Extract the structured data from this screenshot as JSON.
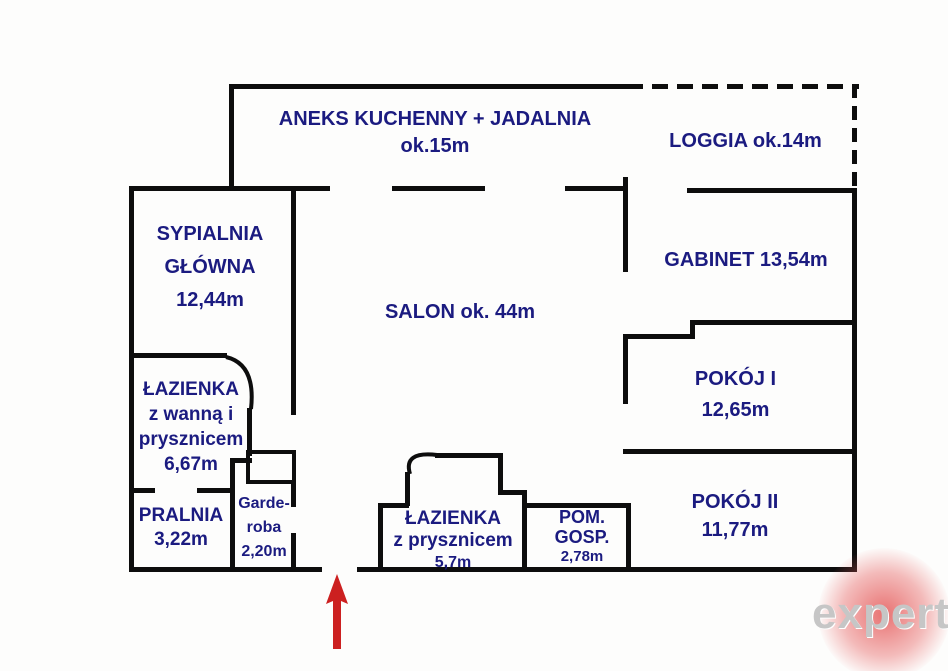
{
  "document": {
    "type": "apartment-floor-plan"
  },
  "colors": {
    "wall": "#0d0d0d",
    "label": "#1b1b80",
    "arrow": "#cc2020",
    "watermark_text": "#c6c6c6",
    "watermark_blob": "#e03c3c",
    "background": "#fdfdfc"
  },
  "rooms": {
    "kitchen": {
      "lines": [
        "ANEKS KUCHENNY + JADALNIA",
        "ok.15m"
      ]
    },
    "loggia": {
      "lines": [
        "LOGGIA ok.14m"
      ]
    },
    "bedroom": {
      "lines": [
        "SYPIALNIA",
        "GŁÓWNA",
        "12,44m"
      ]
    },
    "salon": {
      "lines": [
        "SALON ok. 44m"
      ]
    },
    "office": {
      "lines": [
        "GABINET 13,54m"
      ]
    },
    "room1": {
      "lines": [
        "POKÓJ I",
        "12,65m"
      ]
    },
    "bath1": {
      "lines": [
        "ŁAZIENKA",
        "z wanną i",
        "prysznicem",
        "6,67m"
      ]
    },
    "laundry": {
      "lines": [
        "PRALNIA",
        "3,22m"
      ]
    },
    "wardrobe": {
      "lines": [
        "Garde-",
        "roba",
        "2,20m"
      ]
    },
    "bath2": {
      "lines": [
        "ŁAZIENKA",
        "z prysznicem",
        "5,7m"
      ]
    },
    "utility": {
      "lines": [
        "POM.",
        "GOSP.",
        "2,78m"
      ]
    },
    "room2": {
      "lines": [
        "POKÓJ II",
        "11,77m"
      ]
    }
  },
  "entrance": {
    "marker": "red-up-arrow"
  },
  "watermark": {
    "text": "expert"
  }
}
